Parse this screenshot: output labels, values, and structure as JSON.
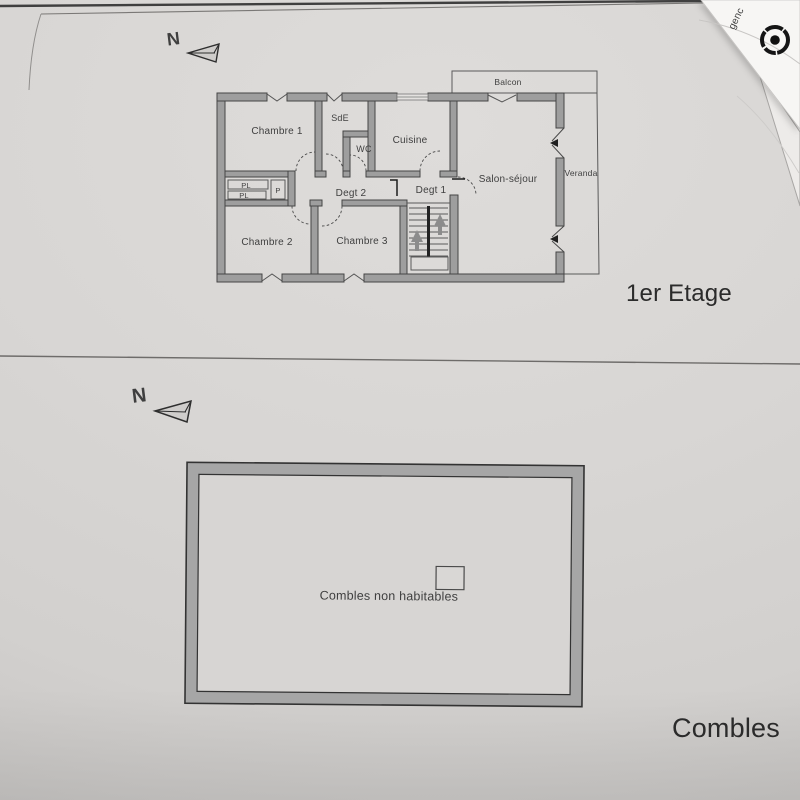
{
  "floor1": {
    "title": "1er Etage",
    "compass_label": "N",
    "labels": {
      "chambre1": "Chambre 1",
      "sde": "SdE",
      "wc": "WC",
      "cuisine": "Cuisine",
      "balcon": "Balcon",
      "salon": "Salon-séjour",
      "veranda": "Veranda",
      "degt2": "Degt 2",
      "degt1": "Degt 1",
      "pl_top": "PL",
      "pl_bottom": "PL",
      "p_closet": "P",
      "chambre2": "Chambre 2",
      "chambre3": "Chambre 3"
    }
  },
  "floor2": {
    "title": "Combles",
    "compass_label": "N",
    "labels": {
      "attic": "Combles non habitables"
    }
  },
  "overlay_paper": {
    "partial_text": "genc"
  },
  "colors": {
    "wall_fill": "#9e9e9e",
    "wall_stroke": "#454545",
    "page_background": "#d7d5d3",
    "divider_line": "#6e6c6a",
    "overlay_paper": "#f7f6f4",
    "logo": "#151515",
    "text": "#3f3f3f"
  }
}
